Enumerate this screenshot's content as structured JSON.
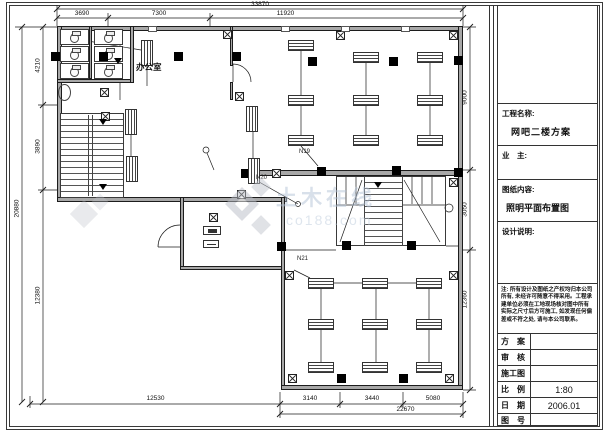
{
  "title_block": {
    "project_label": "工程名称:",
    "project_name": "网吧二楼方案",
    "owner_label": "业　主:",
    "content_label": "图纸内容:",
    "content_name": "照明平面布置图",
    "design_label": "设计说明:",
    "note": "注: 所有设计及图纸之产权均归本公司所有, 未经许可随意不得采用。工程承建单位必须在工地现场核对图中所有实际之尺寸后方可施工, 如发现任何偏差或不符之处, 请与本公司联系。",
    "rows": [
      {
        "label": "方　案",
        "value": ""
      },
      {
        "label": "审　核",
        "value": ""
      },
      {
        "label": "施工图",
        "value": ""
      },
      {
        "label": "比　例",
        "value": "1:80"
      },
      {
        "label": "日　期",
        "value": "2006.01"
      },
      {
        "label": "图　号",
        "value": ""
      }
    ]
  },
  "plan": {
    "room_label": "办公室",
    "circuit_labels": {
      "n19": "N19",
      "n20": "N20",
      "n21": "N21"
    },
    "dims": {
      "top_total": "33870",
      "top": [
        "3690",
        "7300",
        "11920"
      ],
      "left_total": "20880",
      "left": [
        "4210",
        "3890",
        "12380"
      ],
      "right": [
        "9000",
        "3050",
        "12360"
      ],
      "bottom": [
        "12530",
        "3140",
        "3440",
        "5080"
      ],
      "bottom_sub": "22670"
    }
  },
  "watermark": {
    "name": "土木在线",
    "domain": "co188.com"
  },
  "colors": {
    "wall": "#a8a8a8",
    "line": "#1c1c1c",
    "watermark_blue": "#b3c2d6"
  }
}
